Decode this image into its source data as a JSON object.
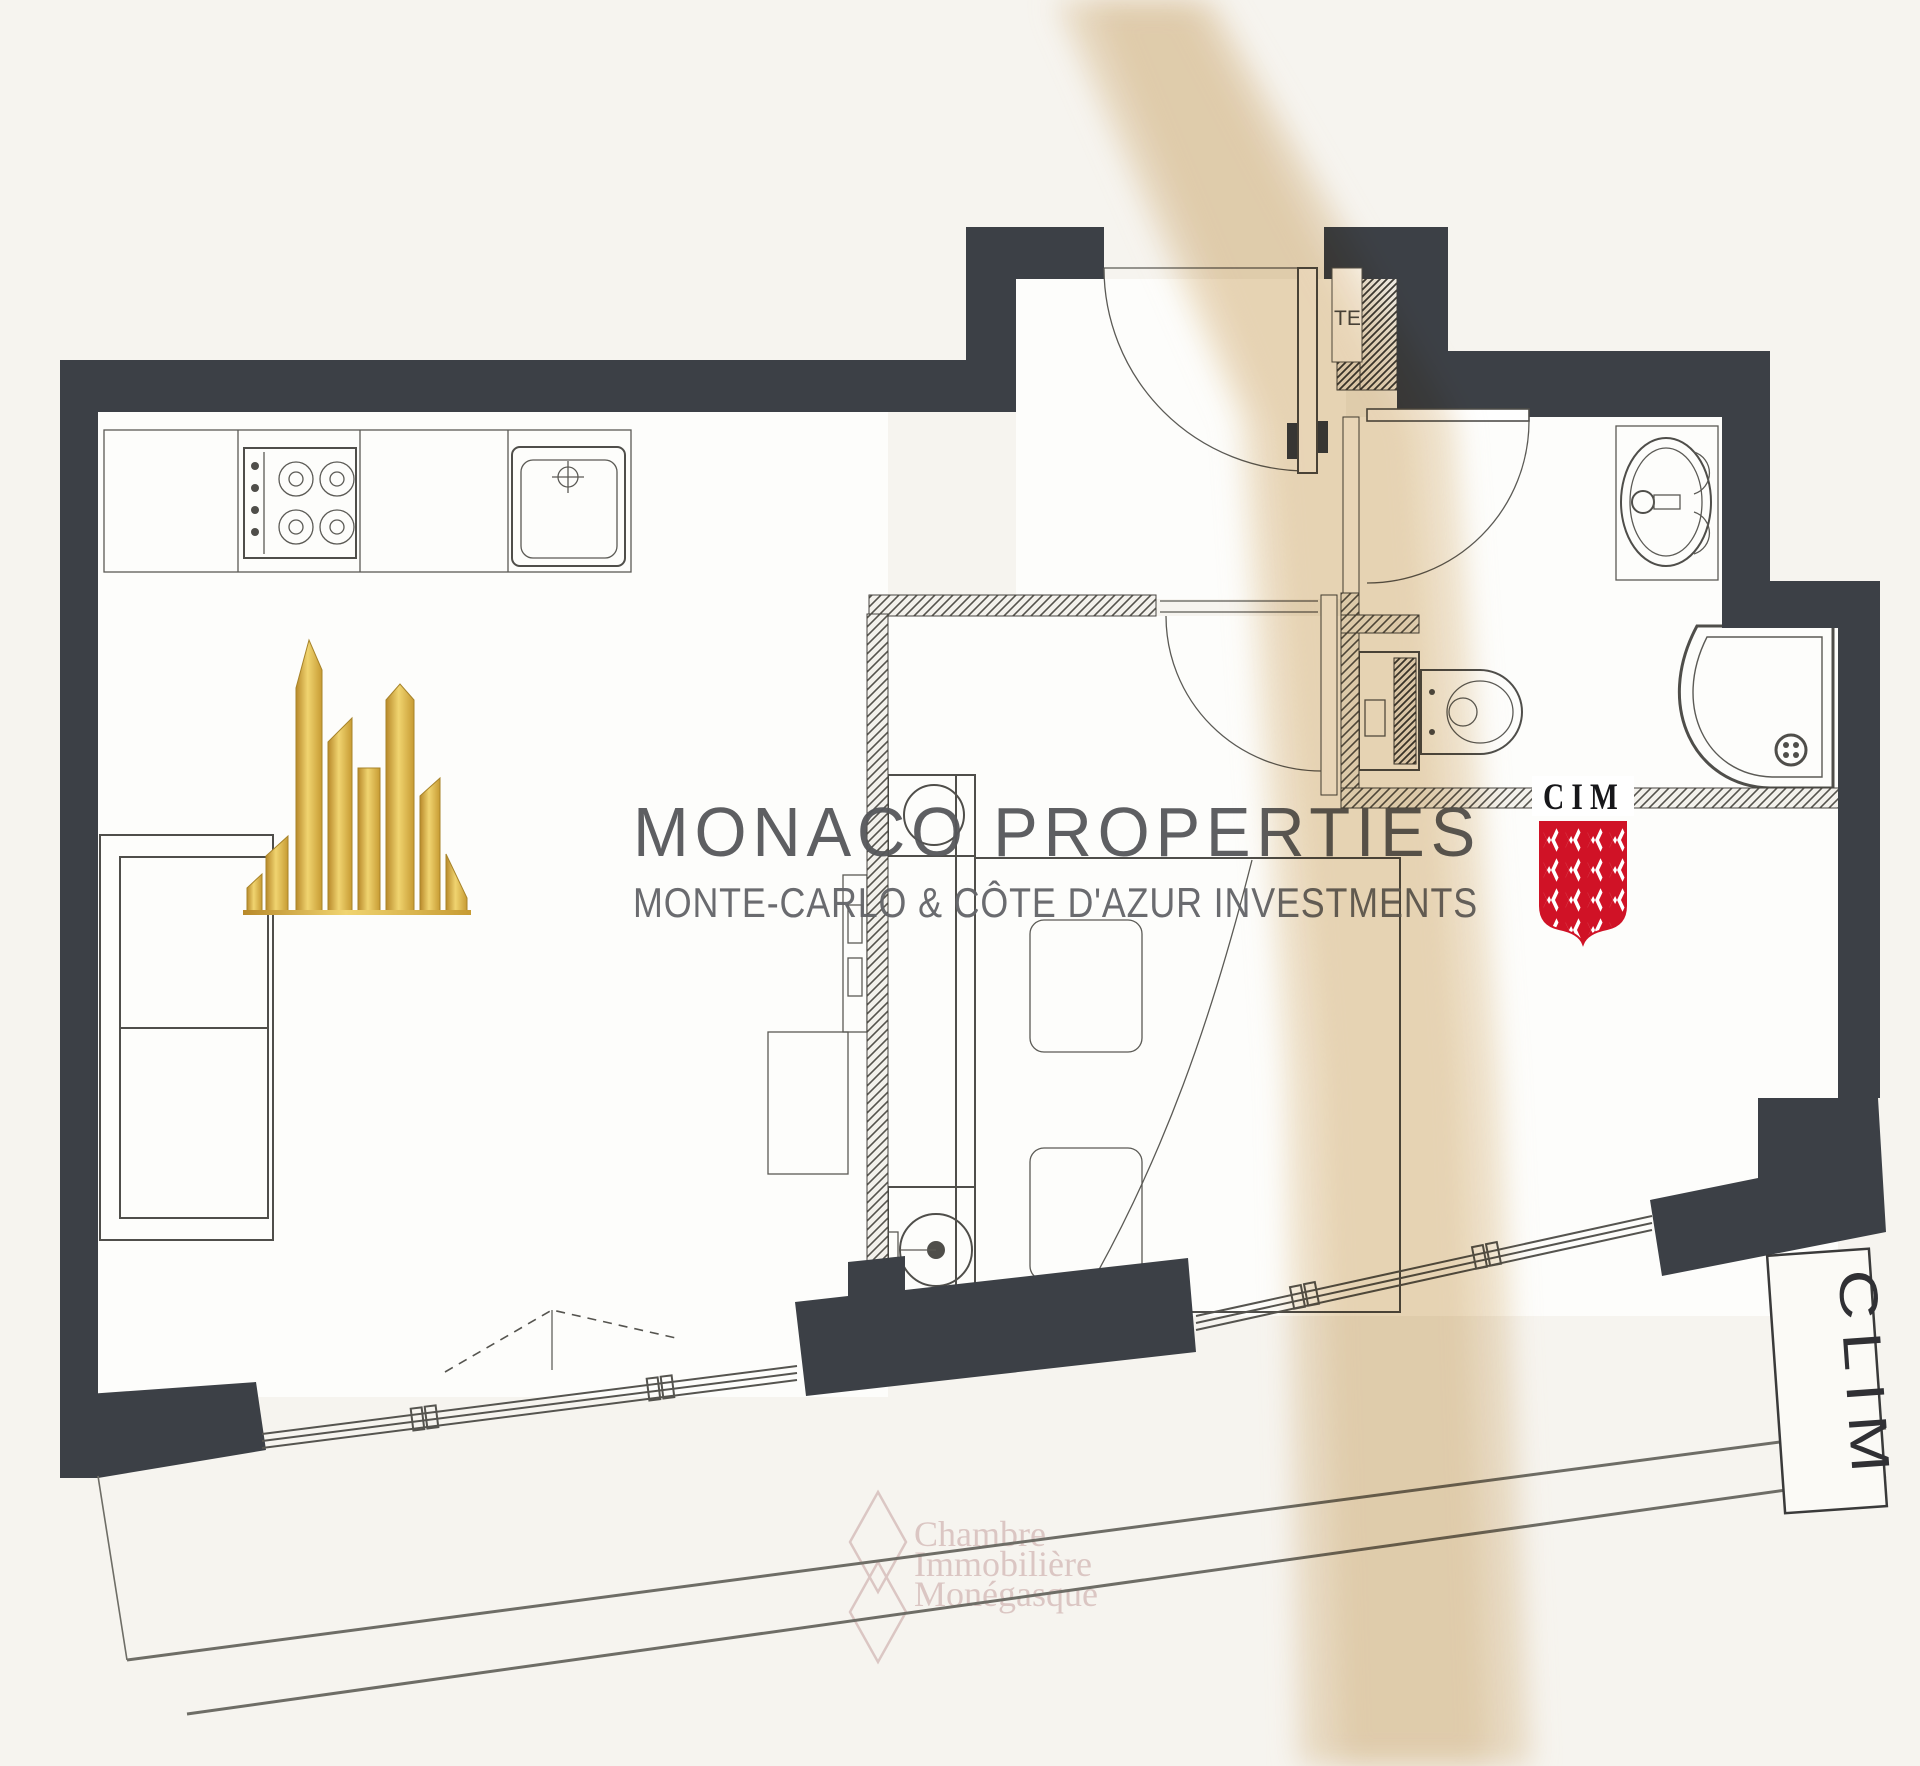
{
  "branding": {
    "title": "MONACO PROPERTIES",
    "subtitle": "MONTE-CARLO & CÔTE D'AZUR INVESTMENTS"
  },
  "stamps": {
    "cim_label": "CIM",
    "clim_label": "CLIM",
    "duct_label": "TE"
  },
  "watermark": {
    "line1": "Chambre",
    "line2": "Immobilière",
    "line3": "Monégasque"
  },
  "colors": {
    "wall_dark": "#3c4046",
    "drawing_line": "#4f4e4a",
    "paper": "#f6f4ef",
    "room_white": "#fdfdfb",
    "scan_band_beige": "#e3cba4",
    "brand_gray": "#56575a",
    "brand_gold": "#d4af37",
    "cim_red": "#d01226",
    "watermark_pink": "#c5a2a0"
  }
}
